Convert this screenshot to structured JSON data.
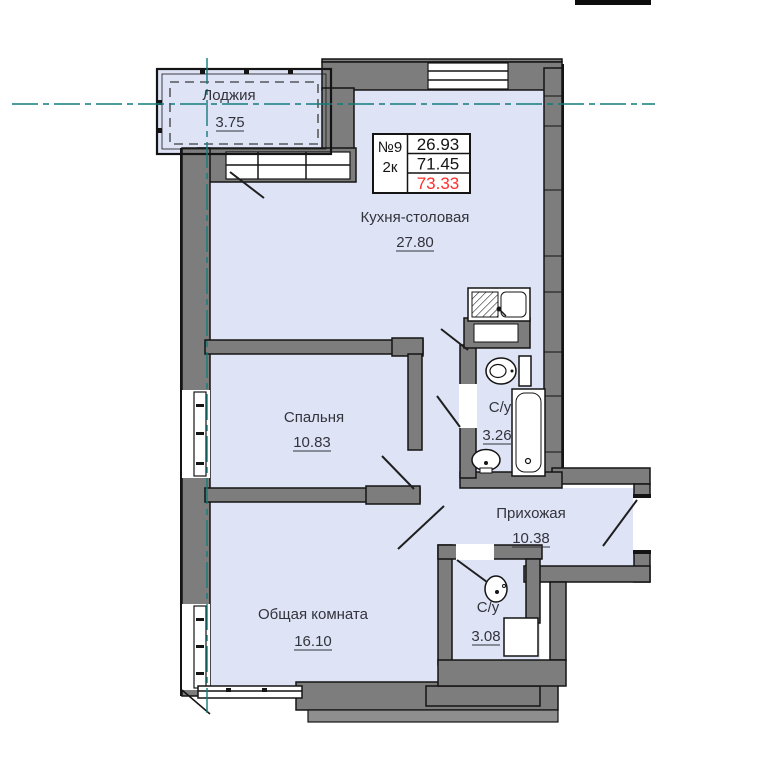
{
  "plan": {
    "unit": {
      "number": "№9",
      "rooms_type": "2к",
      "values": [
        "26.93",
        "71.45",
        "73.33"
      ]
    },
    "rooms": {
      "loggia": {
        "name": "Лоджия",
        "area": "3.75"
      },
      "kitchen": {
        "name": "Кухня-столовая",
        "area": "27.80"
      },
      "bedroom": {
        "name": "Спальня",
        "area": "10.83"
      },
      "bathroom_top": {
        "name": "С/у",
        "area": "3.26"
      },
      "hallway": {
        "name": "Прихожая",
        "area": "10.38"
      },
      "living": {
        "name": "Общая комната",
        "area": "16.10"
      },
      "bathroom_bottom": {
        "name": "С/у",
        "area": "3.08"
      }
    },
    "colors": {
      "floor": "#dee4f6",
      "wall": "#7d7d7d",
      "wall_outline": "#141414",
      "axis_teal": "#127b7b",
      "highlight_red": "#ff2d2d",
      "label_text": "#33333c"
    },
    "icons": [
      "kitchen-sink-icon",
      "toilet-icon",
      "bathtub-icon",
      "washbasin-icon",
      "washing-machine-icon"
    ]
  }
}
